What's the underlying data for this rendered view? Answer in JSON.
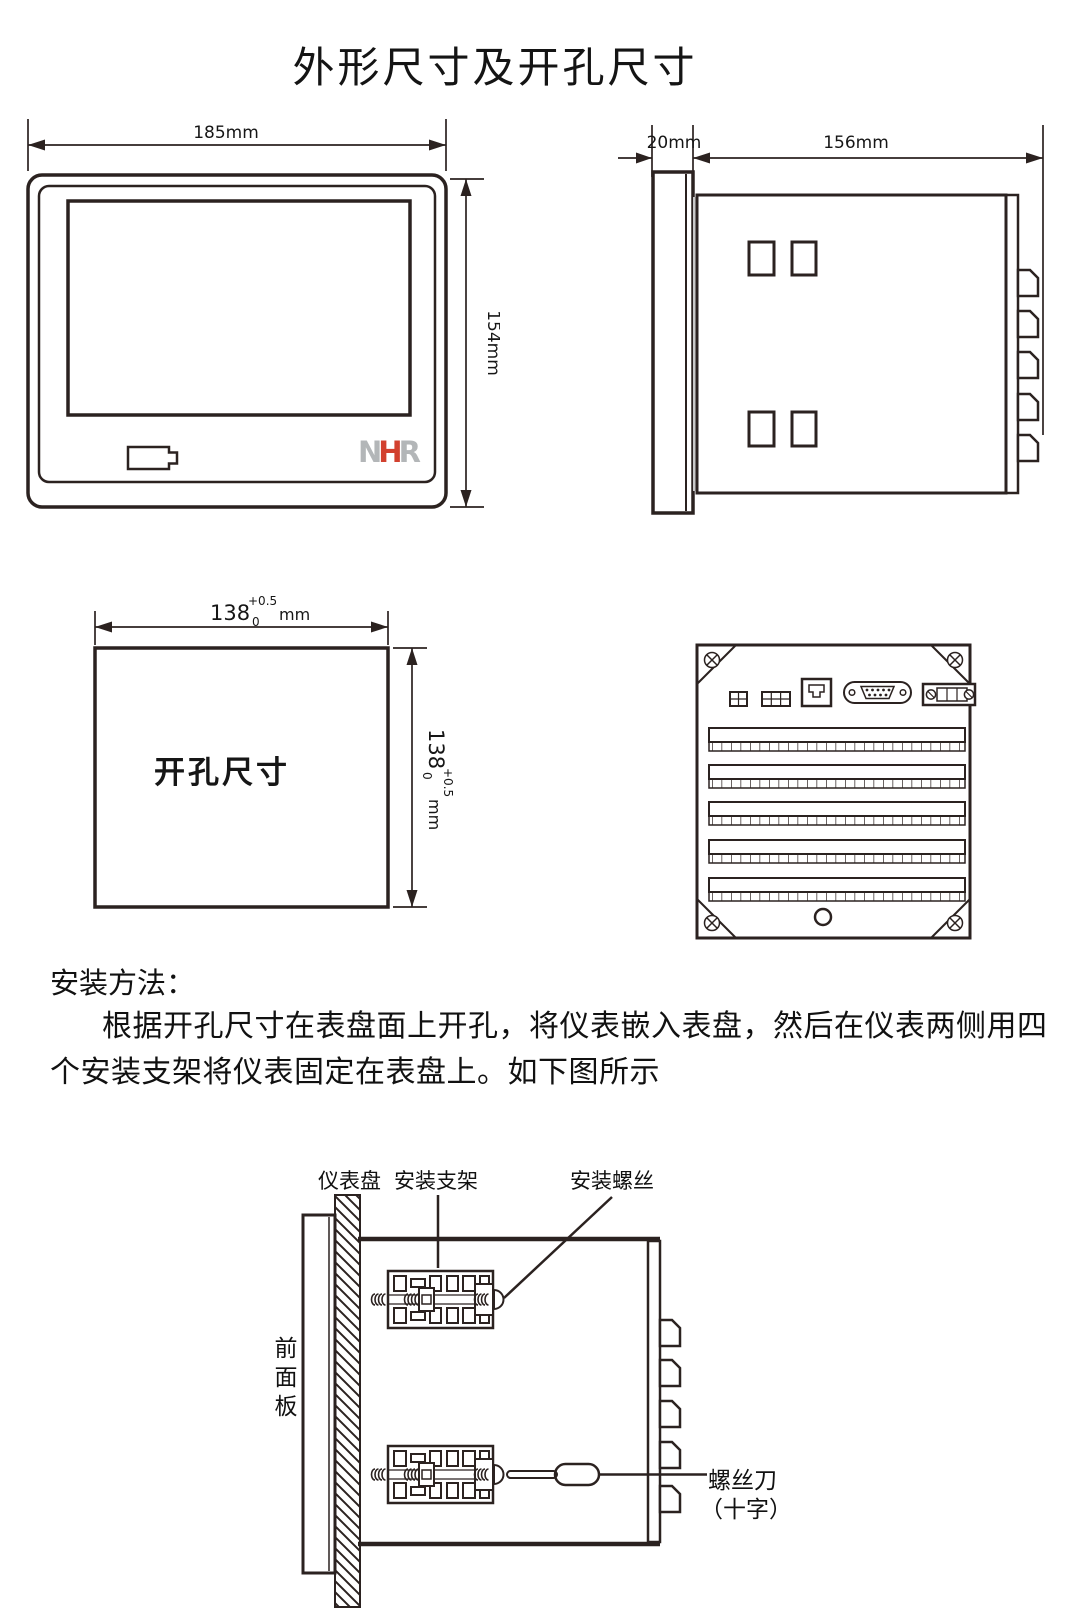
{
  "page": {
    "title": "外形尺寸及开孔尺寸"
  },
  "front_view": {
    "width_label": "185mm",
    "height_label": "154mm",
    "logo": {
      "letter1": "N",
      "letter2": "H",
      "letter3": "R"
    }
  },
  "side_view": {
    "bezel_depth_label": "20mm",
    "body_depth_label": "156mm"
  },
  "cutout_view": {
    "center_label": "开孔尺寸",
    "width": {
      "value": "138",
      "tol_upper": "+0.5",
      "tol_lower": "0",
      "unit": "mm"
    },
    "height": {
      "value": "138",
      "tol_upper": "+0.5",
      "tol_lower": "0",
      "unit": "mm"
    }
  },
  "install": {
    "heading": "安装方法：",
    "body_line1": "根据开孔尺寸在表盘面上开孔，将仪表嵌入表盘，然后在仪表两侧用四",
    "body_line2": "个安装支架将仪表固定在表盘上。如下图所示",
    "labels": {
      "panel": "仪表盘",
      "bracket": "安装支架",
      "screw": "安装螺丝",
      "front_panel": "前面板",
      "screwdriver_line1": "螺丝刀",
      "screwdriver_line2": "（十字）"
    }
  },
  "colors": {
    "line": "#2b2220",
    "text": "#161616",
    "cutout_fill": "#d8d8d8",
    "side_shadow": "#c8c8c8",
    "logo_gray": "#b3b6b8",
    "logo_red": "#d2402e",
    "handle_fill": "#c9c9c9"
  }
}
